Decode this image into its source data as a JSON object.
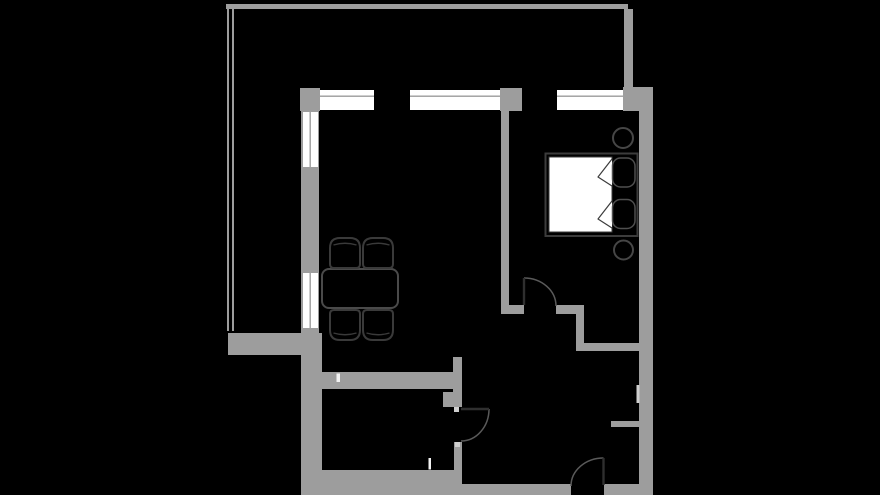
{
  "canvas": {
    "width": 880,
    "height": 495
  },
  "colors": {
    "background": "#000000",
    "wall": "#9d9d9d",
    "wall_light": "#cfcfcf",
    "window_white": "#ffffff",
    "outline_dark": "#3c3c3c",
    "outline_mid": "#4a4a4a",
    "chair_outline": "#3a3a3a",
    "pillow_outline": "#4f4f4f",
    "circle_outline": "#464646",
    "arc": "#5a5a5a",
    "leaf": "#2f2f2f",
    "mark_white": "#f2f2f2"
  },
  "walls": [
    {
      "name": "balcony-top-wall",
      "x": 226,
      "y": 4,
      "w": 402,
      "h": 5
    },
    {
      "name": "balcony-rail-outer",
      "x": 227,
      "y": 4,
      "w": 2,
      "h": 327
    },
    {
      "name": "balcony-rail-inner",
      "x": 232,
      "y": 9,
      "w": 2,
      "h": 322
    },
    {
      "name": "balcony-right-wall",
      "x": 624,
      "y": 9,
      "w": 9,
      "h": 79
    },
    {
      "name": "balcony-bottom-wall",
      "x": 228,
      "y": 333,
      "w": 75,
      "h": 22
    },
    {
      "name": "top-wall-left-corner",
      "x": 300,
      "y": 88,
      "w": 20,
      "h": 23
    },
    {
      "name": "top-wall-center-pier",
      "x": 500,
      "y": 88,
      "w": 22,
      "h": 23
    },
    {
      "name": "top-wall-right-corner",
      "x": 623,
      "y": 87,
      "w": 30,
      "h": 24
    },
    {
      "name": "left-wall-upper",
      "x": 301,
      "y": 88,
      "w": 18,
      "h": 245
    },
    {
      "name": "left-wall-mid",
      "x": 301,
      "y": 333,
      "w": 21,
      "h": 22
    },
    {
      "name": "left-wall-lower",
      "x": 301,
      "y": 355,
      "w": 21,
      "h": 140
    },
    {
      "name": "right-wall",
      "x": 639,
      "y": 87,
      "w": 14,
      "h": 408
    },
    {
      "name": "bottom-wall-kitchen",
      "x": 301,
      "y": 470,
      "w": 161,
      "h": 25
    },
    {
      "name": "bottom-wall-entry-left",
      "x": 462,
      "y": 484,
      "w": 109,
      "h": 11
    },
    {
      "name": "bottom-wall-entry-right",
      "x": 604,
      "y": 484,
      "w": 49,
      "h": 11
    },
    {
      "name": "living-bedroom-divider-wall",
      "x": 501,
      "y": 111,
      "w": 8,
      "h": 199
    },
    {
      "name": "bedroom-door-jamb-wall",
      "x": 501,
      "y": 305,
      "w": 23,
      "h": 9
    },
    {
      "name": "bedroom-wall-right",
      "x": 556,
      "y": 305,
      "w": 28,
      "h": 9
    },
    {
      "name": "bedroom-nook-step-wall",
      "x": 576,
      "y": 305,
      "w": 8,
      "h": 38
    },
    {
      "name": "bedroom-nook-bottom-wall",
      "x": 576,
      "y": 343,
      "w": 64,
      "h": 8
    },
    {
      "name": "kitchen-top-wall",
      "x": 322,
      "y": 372,
      "w": 140,
      "h": 17
    },
    {
      "name": "kitchen-wall-stub-upper",
      "x": 453,
      "y": 357,
      "w": 9,
      "h": 35
    },
    {
      "name": "kitchen-door-pier",
      "x": 443,
      "y": 392,
      "w": 19,
      "h": 15
    },
    {
      "name": "kitchen-right-wall-lower",
      "x": 454,
      "y": 442,
      "w": 8,
      "h": 28
    },
    {
      "name": "entry-niche-stub-wall",
      "x": 611,
      "y": 421,
      "w": 28,
      "h": 6
    }
  ],
  "marks": [
    {
      "name": "kitchen-door-jamb-upper",
      "x": 454,
      "y": 407,
      "w": 5,
      "h": 5,
      "tone": "light"
    },
    {
      "name": "kitchen-door-jamb-lower",
      "x": 455,
      "y": 442,
      "w": 5,
      "h": 5,
      "tone": "light"
    },
    {
      "name": "right-wall-vent-notch",
      "x": 636.5,
      "y": 385,
      "w": 3,
      "h": 18,
      "tone": "light"
    },
    {
      "name": "kitchen-top-wall-mark",
      "x": 336.5,
      "y": 373.5,
      "w": 3.5,
      "h": 8.5,
      "tone": "white"
    },
    {
      "name": "kitchen-bottom-wall-mark",
      "x": 428.5,
      "y": 458,
      "w": 2.5,
      "h": 11.5,
      "tone": "white"
    }
  ],
  "windows": [
    {
      "name": "top-window-living-1",
      "x": 320,
      "y": 90,
      "w": 54,
      "h": 20,
      "orient": "h",
      "line_offset": 5.5
    },
    {
      "name": "top-window-living-2",
      "x": 410,
      "y": 90,
      "w": 90,
      "h": 20,
      "orient": "h",
      "line_offset": 5.5
    },
    {
      "name": "top-window-bedroom",
      "x": 557,
      "y": 90,
      "w": 66,
      "h": 20,
      "orient": "h",
      "line_offset": 5.5
    },
    {
      "name": "left-window-upper",
      "x": 303,
      "y": 112,
      "w": 15,
      "h": 55,
      "orient": "v",
      "line_offset": 6.5
    },
    {
      "name": "left-window-lower",
      "x": 303,
      "y": 273,
      "w": 15,
      "h": 55,
      "orient": "v",
      "line_offset": 6.5
    }
  ],
  "doors": [
    {
      "name": "bedroom-door",
      "leaf": {
        "x1": 524,
        "y1": 278,
        "x2": 524,
        "y2": 305
      },
      "arc": "M524,278 A32,28 0 0 1 556,306"
    },
    {
      "name": "kitchen-door",
      "leaf": {
        "x1": 461,
        "y1": 409,
        "x2": 489,
        "y2": 409
      },
      "arc": "M489,409 A28,32 0 0 1 461,441"
    },
    {
      "name": "entry-door",
      "leaf": {
        "x1": 603.5,
        "y1": 458,
        "x2": 603.5,
        "y2": 485
      },
      "arc": "M603.5,458 A32.5,28 0 0 0 571,486"
    }
  ],
  "furniture": {
    "bed_frame": {
      "name": "bed-frame",
      "x": 545.5,
      "y": 153.5,
      "w": 92,
      "h": 82.5
    },
    "bed_mattress": {
      "name": "bed-mattress",
      "x": 549,
      "y": 157,
      "w": 63,
      "h": 75
    },
    "pillows": [
      {
        "name": "pillow-top",
        "x": 612.5,
        "y": 158,
        "w": 22.5,
        "h": 29
      },
      {
        "name": "pillow-bottom",
        "x": 612.5,
        "y": 199.5,
        "w": 22.5,
        "h": 29
      }
    ],
    "blanket_folds": [
      {
        "name": "blanket-fold-top",
        "points": "612,159 598,177 612,186"
      },
      {
        "name": "blanket-fold-bottom",
        "points": "612,201 598,219 612,228"
      }
    ],
    "side_tables": [
      {
        "name": "round-side-table-top",
        "cx": 623,
        "cy": 138,
        "r": 10
      },
      {
        "name": "round-side-table-bottom",
        "cx": 623.5,
        "cy": 250,
        "r": 9.5
      }
    ],
    "dining_table": {
      "name": "dining-table",
      "x": 322,
      "y": 269,
      "w": 76,
      "h": 39,
      "r": 7
    },
    "chairs": [
      {
        "name": "chair-top-left",
        "x": 330,
        "y": 238,
        "w": 30,
        "h": 30,
        "back": "top"
      },
      {
        "name": "chair-top-right",
        "x": 363,
        "y": 238,
        "w": 30,
        "h": 30,
        "back": "top"
      },
      {
        "name": "chair-bottom-left",
        "x": 330,
        "y": 310,
        "w": 30,
        "h": 30,
        "back": "bottom"
      },
      {
        "name": "chair-bottom-right",
        "x": 363,
        "y": 310,
        "w": 30,
        "h": 30,
        "back": "bottom"
      }
    ]
  }
}
